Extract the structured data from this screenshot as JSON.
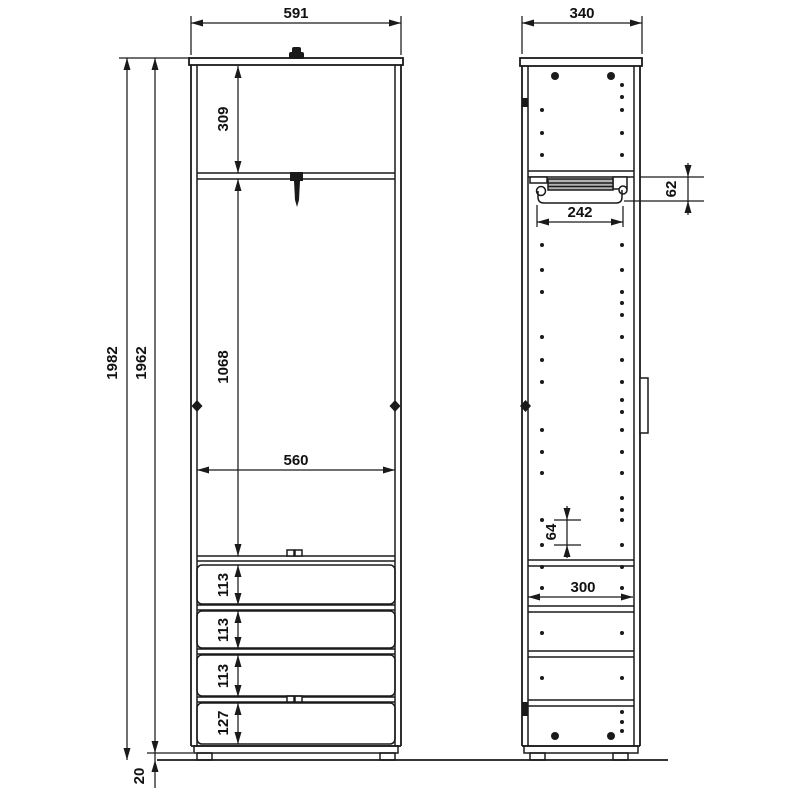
{
  "drawing": {
    "background_color": "#ffffff",
    "line_color": "#1a1a1a"
  },
  "front_view": {
    "width": "591",
    "overall_height": "1982",
    "carcass_height": "1962",
    "top_section": "309",
    "hanging_section": "1068",
    "inner_width": "560",
    "drawer_heights": [
      "113",
      "113",
      "113",
      "127"
    ],
    "foot_height": "20"
  },
  "side_view": {
    "depth": "340",
    "rail_length": "242",
    "rail_clearance": "62",
    "hole_pitch": "64",
    "inner_depth": "300"
  }
}
